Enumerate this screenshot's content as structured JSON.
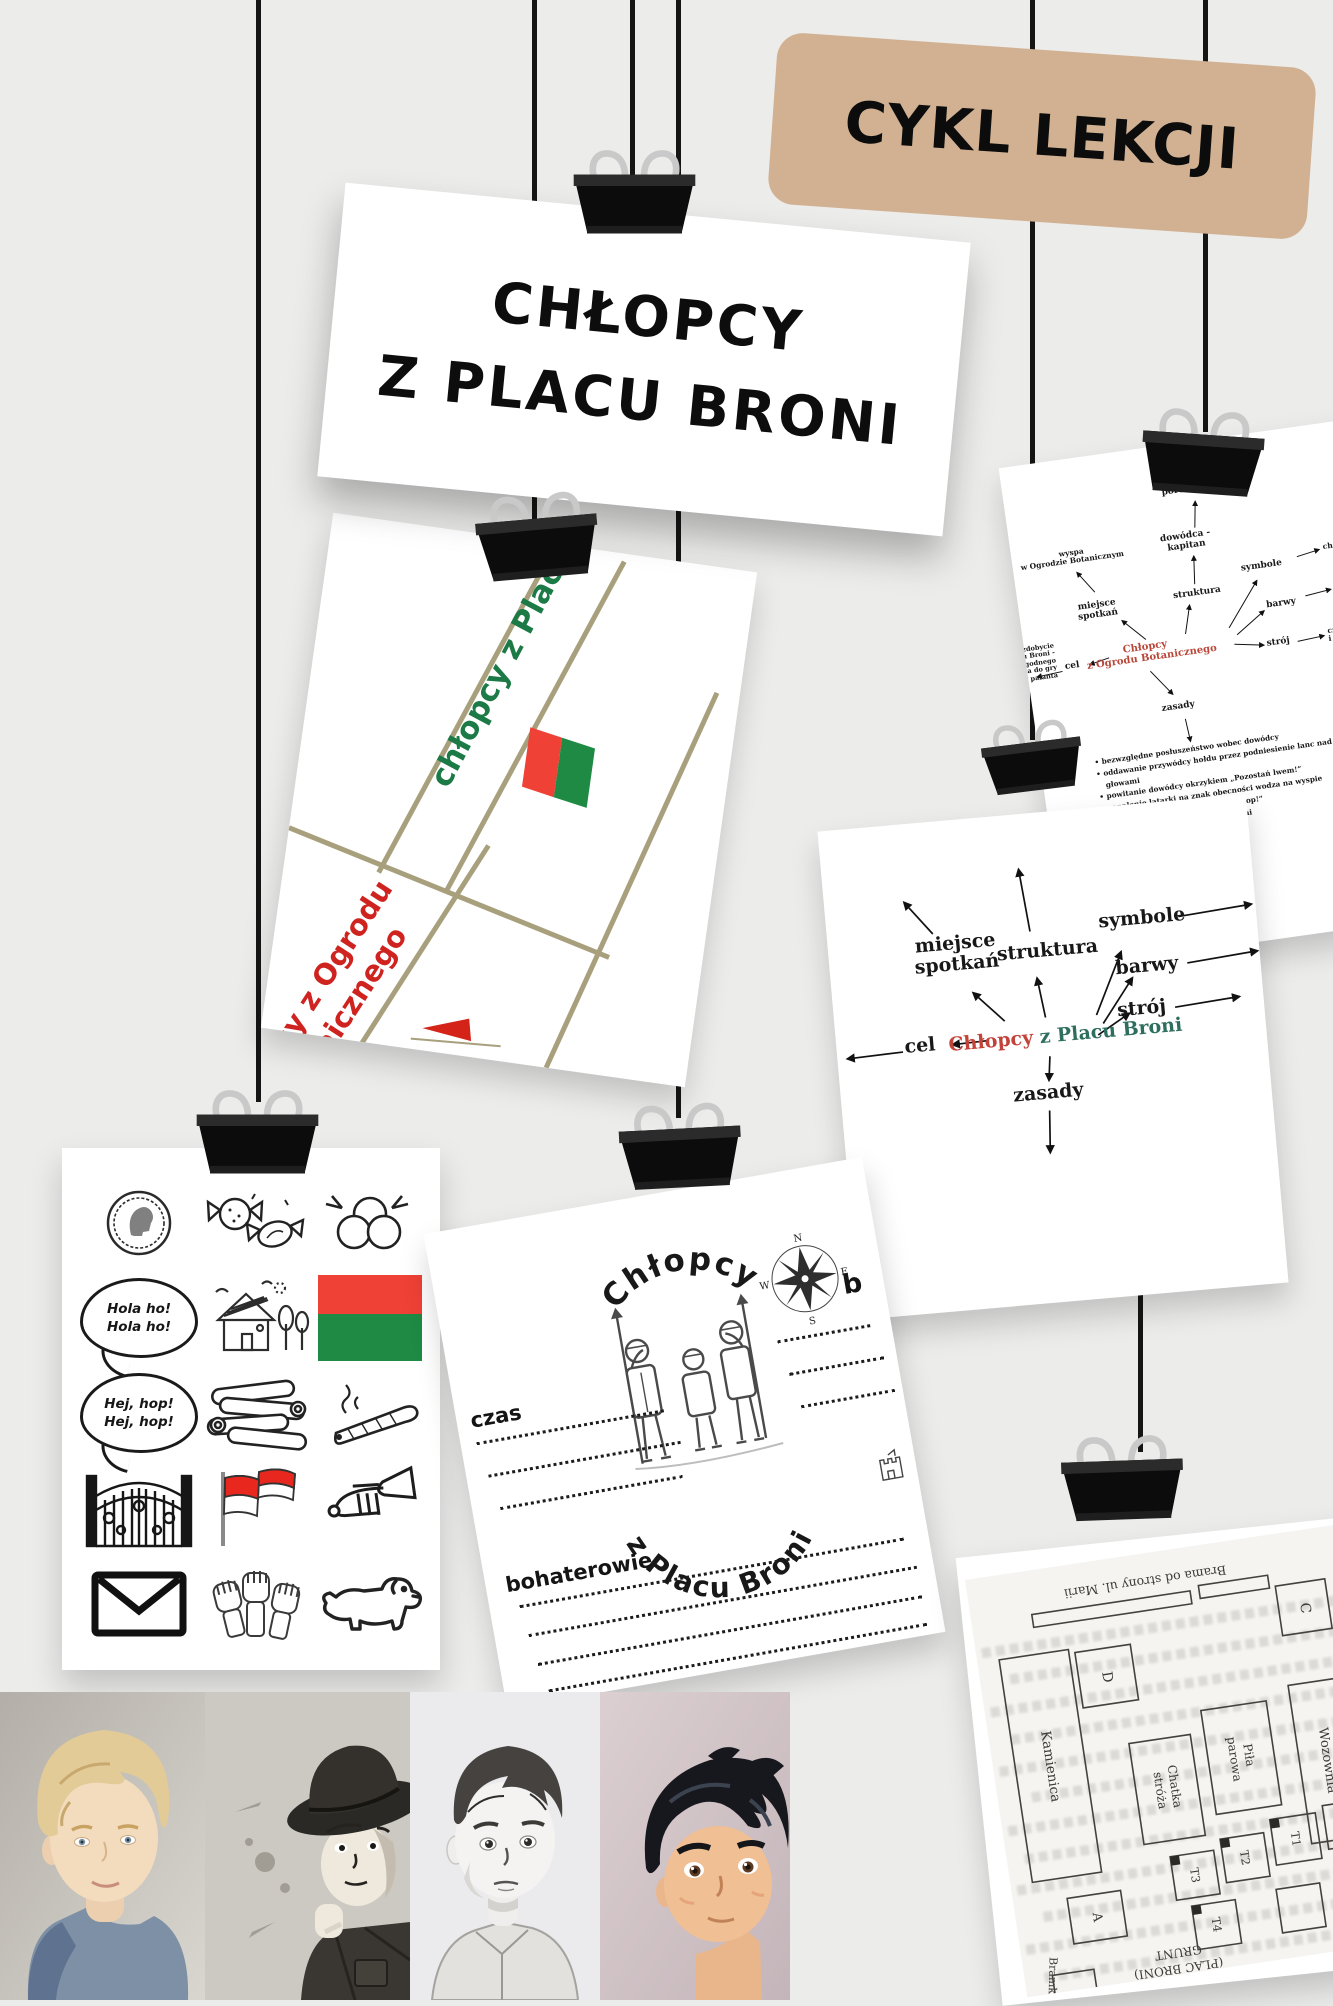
{
  "page": {
    "bg": "#ececeb"
  },
  "badge": {
    "label": "CYKL LEKCJI",
    "bg_color": "#d1b192"
  },
  "banner": {
    "line1": "CHŁOPCY",
    "line2": "Z PLACU BRONI"
  },
  "map_card": {
    "green_label": "chłopcy z Placu Broni",
    "red_label_line1": "chłopcy z Ogrodu",
    "red_label_line2": "Botanicznego",
    "green_color": "#1b7a45",
    "red_color": "#cf2320",
    "street_color": "#a8a07d",
    "flag_red": "#ef4136",
    "flag_green": "#1e8a44"
  },
  "mindmap_small": {
    "center_line1": "Chłopcy",
    "center_line2": "z Ogrodu Botanicznego",
    "center_color": "#b8473a",
    "nodes": {
      "zastepcy_l1": "zastępcy -",
      "zastepcy_l2": "porucznicy",
      "dowodca_l1": "dowódca -",
      "dowodca_l2": "kapitan",
      "wyspa_l1": "wyspa",
      "wyspa_l2": "w Ogrodzie Botanicznym",
      "miejsce_l1": "miejsce",
      "miejsce_l2": "spotkań",
      "struktura": "struktura",
      "symbole": "symbole",
      "choragiewki": "chorągiewki",
      "barwy": "barwy",
      "czerwone": "czerwone",
      "stroj": "strój",
      "stroj_l1": "czerwone koszule",
      "stroj_l2": "i czapki",
      "cel": "cel",
      "cel_l1": "zdobycie",
      "cel_l2": "Placu Broni -",
      "cel_l3": "dogodnego",
      "cel_l4": "miejsca do gry",
      "cel_l5": "w palanta",
      "zasady": "zasady"
    },
    "rules": [
      "bezwzględne posłuszeństwo wobec dowódcy",
      "oddawanie przywódcy hołdu przez podniesienie lanc nad głowami",
      "powitanie dowódcy okrzykiem „Pozostań lwem!”",
      "zapalenie latarki na znak obecności wodza na wyspie",
      "wojenny okrzyk: „Hej, hop! Hej, hop!”",
      "kary za znęcanie się nad słabszymi",
      "brak tolerancji dla tchórzy",
      "potępianie zdrady i przekupstwa"
    ]
  },
  "mindmap_large": {
    "center_red": "Chłopcy",
    "center_green": "z Placu Broni",
    "red_color": "#c2433a",
    "green_color": "#2e6e5e",
    "nodes": {
      "miejsce_l1": "miejsce",
      "miejsce_l2": "spotkań",
      "struktura": "struktura",
      "symbole": "symbole",
      "barwy": "barwy",
      "stroj": "strój",
      "cel": "cel",
      "zasady": "zasady"
    }
  },
  "icons_card": {
    "bubble1_line1": "Hola ho!",
    "bubble1_line2": "Hola ho!",
    "bubble2_line1": "Hej, hop!",
    "bubble2_line2": "Hej, hop!",
    "icons": [
      "coin",
      "candies",
      "marbles",
      "speech-bubble-hola",
      "house",
      "red-green-flag",
      "speech-bubble-hej",
      "logs",
      "cigar",
      "gate",
      "red-white-flags",
      "trumpet",
      "envelope",
      "fists",
      "dog"
    ]
  },
  "worksheet": {
    "arch_top": "Chłopcy",
    "arch_bottom": "z Placu Broni",
    "czas_label": "czas",
    "bohaterowie_label": "bohaterowie",
    "letter_b": "b",
    "compass": {
      "n": "N",
      "e": "E",
      "s": "S",
      "w": "W"
    }
  },
  "plan_card": {
    "top_gate": "Brama od strony ul. Marii",
    "bottom_gate": "Bramka od strony",
    "kamienica": "Kamienica",
    "wozownia": "Wozownia",
    "pila_l1": "Piła",
    "pila_l2": "parowa",
    "chatka_l1": "Chatka",
    "chatka_l2": "stróża",
    "c": "C",
    "d": "D",
    "a": "A",
    "t1": "T1",
    "t2": "T2",
    "t3": "T3",
    "t4": "T4",
    "grunt_l1": "GRUNT",
    "grunt_l2": "(PLAC BRONI)"
  },
  "portraits": [
    "blond-boy-portrait",
    "scout-hat-boy-portrait",
    "sketch-boy-portrait",
    "anime-boy-portrait"
  ]
}
